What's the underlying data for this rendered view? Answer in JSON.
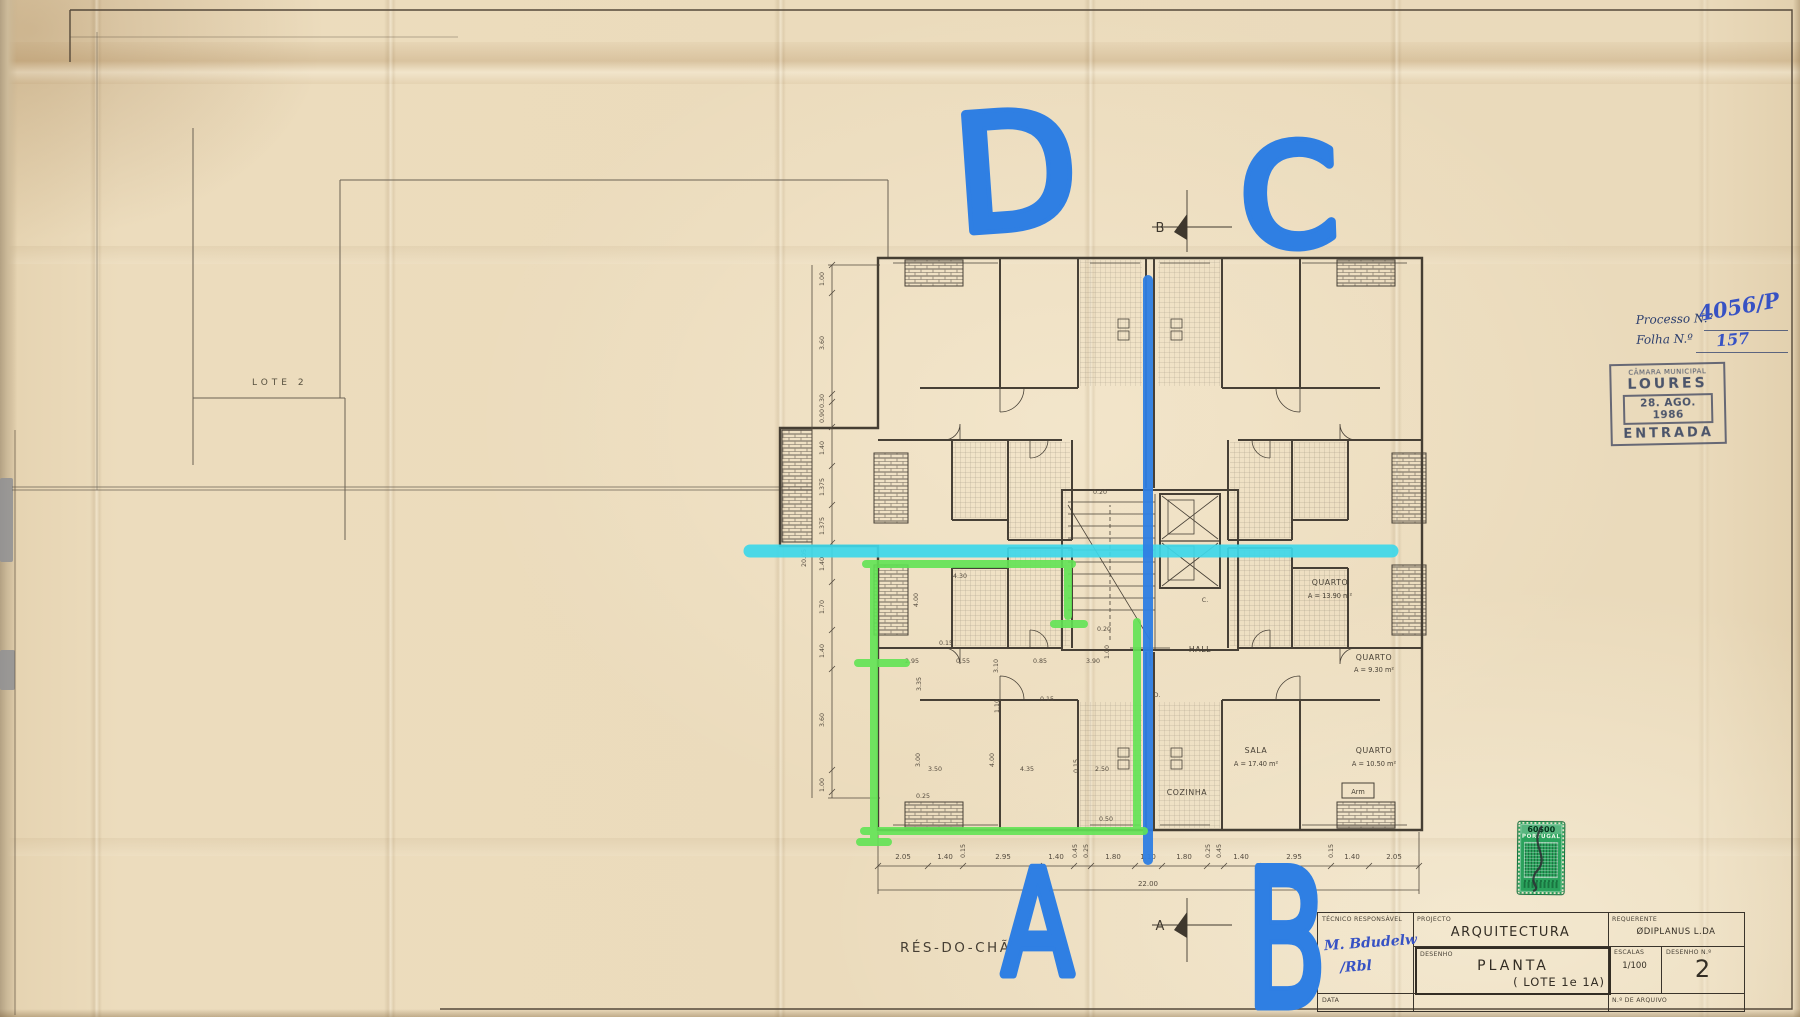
{
  "sheet": {
    "lot_boundary_label": "LOTE 2",
    "floor_label": "RÉS-DO-CHÃO"
  },
  "admin": {
    "processo_label": "Processo N.º",
    "processo_value": "4056/P",
    "folha_label": "Folha N.º",
    "folha_value": "157",
    "entry_stamp": {
      "org": "CÂMARA MUNICIPAL",
      "city": "LOURES",
      "date": "28. AGO. 1986",
      "word": "ENTRADA"
    },
    "tax_stamp": {
      "value": "60$00",
      "country": "PORTUGAL"
    }
  },
  "annotations": {
    "letter_d": "D",
    "letter_c": "C",
    "letter_a": "A",
    "letter_b": "B"
  },
  "plan": {
    "section_marker_top": "B",
    "section_marker_bottom": "A",
    "rooms": {
      "quarto1": {
        "name": "QUARTO",
        "area": "A = 13.90 m²"
      },
      "quarto2": {
        "name": "QUARTO",
        "area": "A = 9.30 m²"
      },
      "sala": {
        "name": "SALA",
        "area": "A = 17.40 m²"
      },
      "quarto3": {
        "name": "QUARTO",
        "area": "A = 10.50 m²"
      },
      "hall": "HALL",
      "cozinha": "COZINHA",
      "arm": "Arm",
      "door_c": "C.",
      "door_d": "D."
    },
    "dims_bottom": [
      "2.05",
      "1.40",
      "0.15",
      "2.95",
      "1.40",
      "0.45",
      "0.25",
      "1.80",
      "1.10",
      "1.80",
      "0.25",
      "0.45",
      "1.40",
      "2.95",
      "0.15",
      "1.40",
      "2.05"
    ],
    "dims_bottom_total": "22.00",
    "dims_left": [
      "1.00",
      "3.60",
      "0.30",
      "0.90",
      "1.40",
      "1.375",
      "1.375",
      "1.40",
      "1.70",
      "1.40",
      "3.60",
      "1.00"
    ],
    "dims_left_total": "20.05",
    "dims_inner": [
      "4.30",
      "4.00",
      "0.15",
      "2.95",
      "3.35",
      "0.55",
      "3.10",
      "0.85",
      "3.90",
      "1.00",
      "0.20",
      "1.10",
      "0.15",
      "3.00",
      "3.50",
      "4.00",
      "4.35",
      "0.15",
      "2.50",
      "0.25",
      "0.50",
      "0.20"
    ]
  },
  "title_block": {
    "tecnico_label": "TÉCNICO RESPONSÁVEL",
    "projecto_label": "PROJECTO",
    "projecto_value": "ARQUITECTURA",
    "requerente_label": "REQUERENTE",
    "requerente_value": "ØDIPLANUS L.DA",
    "desenho_label": "DESENHO",
    "desenho_value": "PLANTA",
    "desenho_value2": "( LOTE 1e 1A)",
    "escalas_label": "ESCALAS",
    "escalas_value": "1/100",
    "numero_label": "DESENHO N.º",
    "numero_value": "2",
    "data_label": "DATA",
    "arquivo_label": "N.º DE ARQUIVO",
    "signature_line1": "M. Bdudelw",
    "signature_line2": "/Rbl"
  },
  "colors": {
    "marker_blue": "#2f7fe3",
    "cyan": "#3ed8ea",
    "green": "#62e455",
    "stamp_green": "#2aa25c",
    "ink": "#4a4237"
  }
}
